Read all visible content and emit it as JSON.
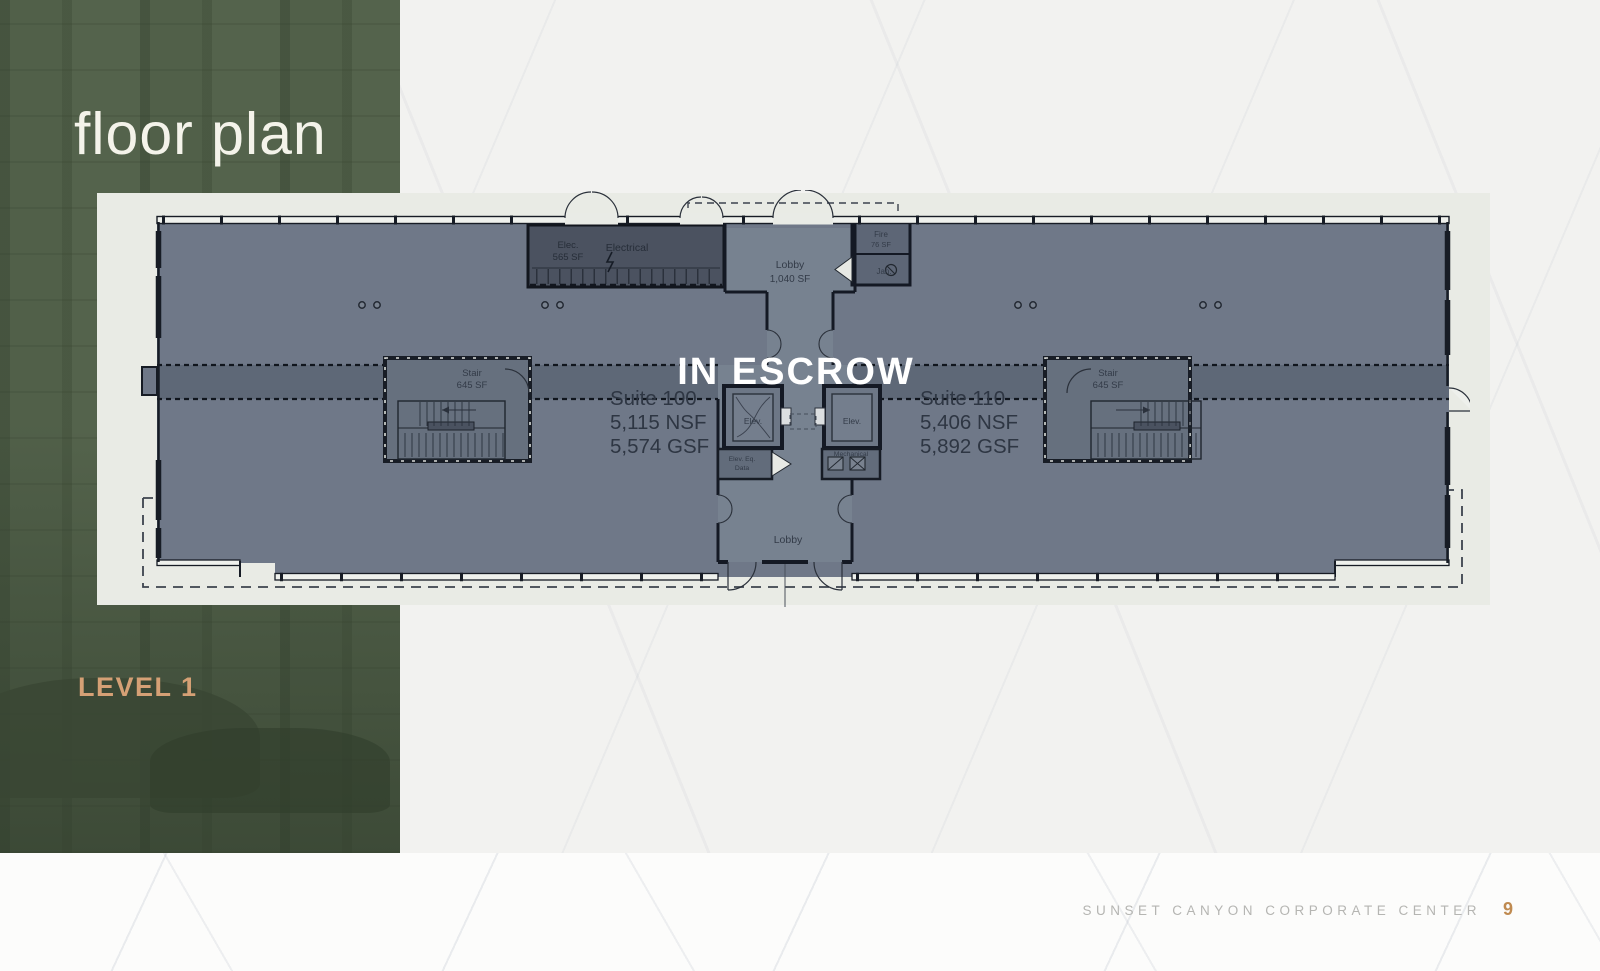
{
  "slide": {
    "title": "floor plan",
    "level_label": "LEVEL 1",
    "footer": {
      "building_name": "SUNSET CANYON CORPORATE CENTER",
      "page_number": "9"
    }
  },
  "floor_plan": {
    "status": "IN ESCROW",
    "suite_left": {
      "name": "Suite 100",
      "nsf": "5,115 NSF",
      "gsf": "5,574 GSF"
    },
    "suite_right": {
      "name": "Suite 110",
      "nsf": "5,406 NSF",
      "gsf": "5,892 GSF"
    },
    "rooms": {
      "lobby_upper_name": "Lobby",
      "lobby_upper_area": "1,040 SF",
      "lobby_lower_name": "Lobby",
      "electrical_abbr": "Elec.",
      "electrical_area": "565 SF",
      "electrical_name": "Electrical",
      "stair_left_name": "Stair",
      "stair_left_area": "645 SF",
      "stair_right_name": "Stair",
      "stair_right_area": "645 SF",
      "elevator_left": "Elev.",
      "elevator_right": "Elev.",
      "elev_equip_line1": "Elev. Eq.",
      "elev_equip_line2": "Data",
      "mechanical": "Mechanical",
      "fire_name": "Fire",
      "fire_area": "76 SF",
      "janitor_name": "Jan."
    }
  },
  "colors": {
    "sidebar_green": "#4e5d47",
    "accent_tan": "#d5a075",
    "page_number_orange": "#bf8a50",
    "plan_floor": "#6f7888",
    "plan_corridor": "#5e6877",
    "plan_core": "#778290",
    "plan_wall": "#161b24",
    "status_text": "#ffffff",
    "panel_background": "#e9ebe5"
  }
}
